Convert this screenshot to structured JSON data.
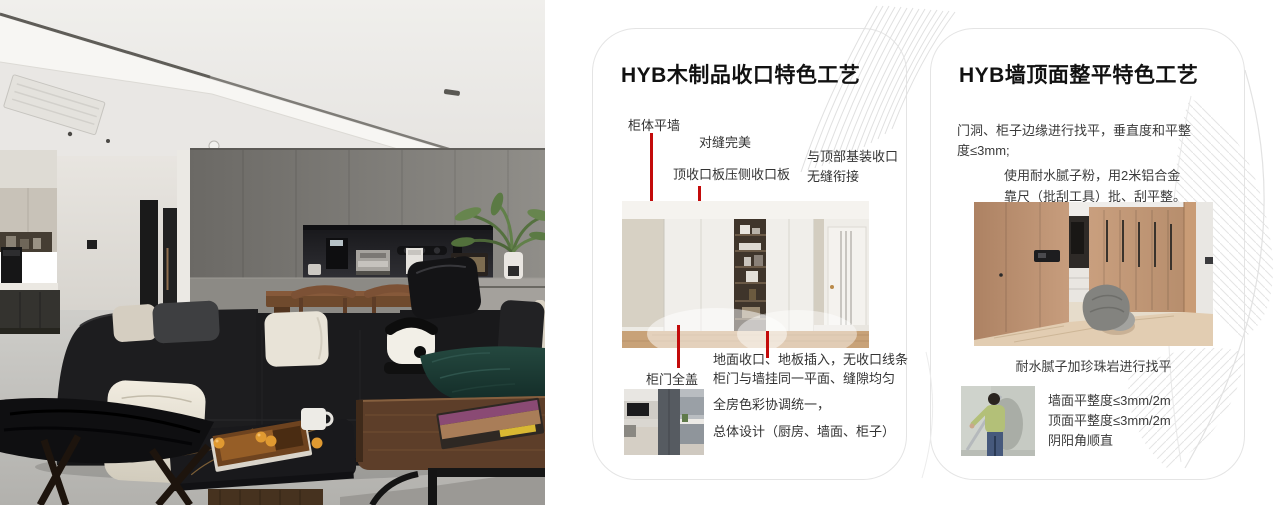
{
  "colors": {
    "annotation_red": "#c30b0b",
    "card_border": "#e4e4e4",
    "title_text": "#111111",
    "body_text": "#3a3a3a",
    "deco_line": "#e3e3e3"
  },
  "card1": {
    "title": "HYB木制品收口特色工艺",
    "label_cabinet_flush": "柜体平墙",
    "label_seam_perfect": "对缝完美",
    "label_top_board": "顶收口板压侧收口板",
    "label_top_seamless": [
      "与顶部基装收口",
      "无缝衔接"
    ],
    "label_door_full_cover": "柜门全盖",
    "label_floor_closing": [
      "地面收口、地板插入，无收口线条",
      "柜门与墙挂同一平面、缝隙均匀"
    ],
    "label_color_harmony": [
      "全房色彩协调统一，",
      "总体设计（厨房、墙面、柜子）"
    ]
  },
  "card2": {
    "title": "HYB墙顶面整平特色工艺",
    "para_leveling": [
      "门洞、柜子边缘进行找平，垂直度和平整",
      "度≤3mm;"
    ],
    "para_putty": [
      "使用耐水腻子粉，用2米铝合金",
      "靠尺（批刮工具）批、刮平整。"
    ],
    "caption_pearlite": "耐水腻子加珍珠岩进行找平",
    "specs": [
      "墙面平整度≤3mm/2m",
      "顶面平整度≤3mm/2m",
      "阴阳角顺直"
    ]
  }
}
